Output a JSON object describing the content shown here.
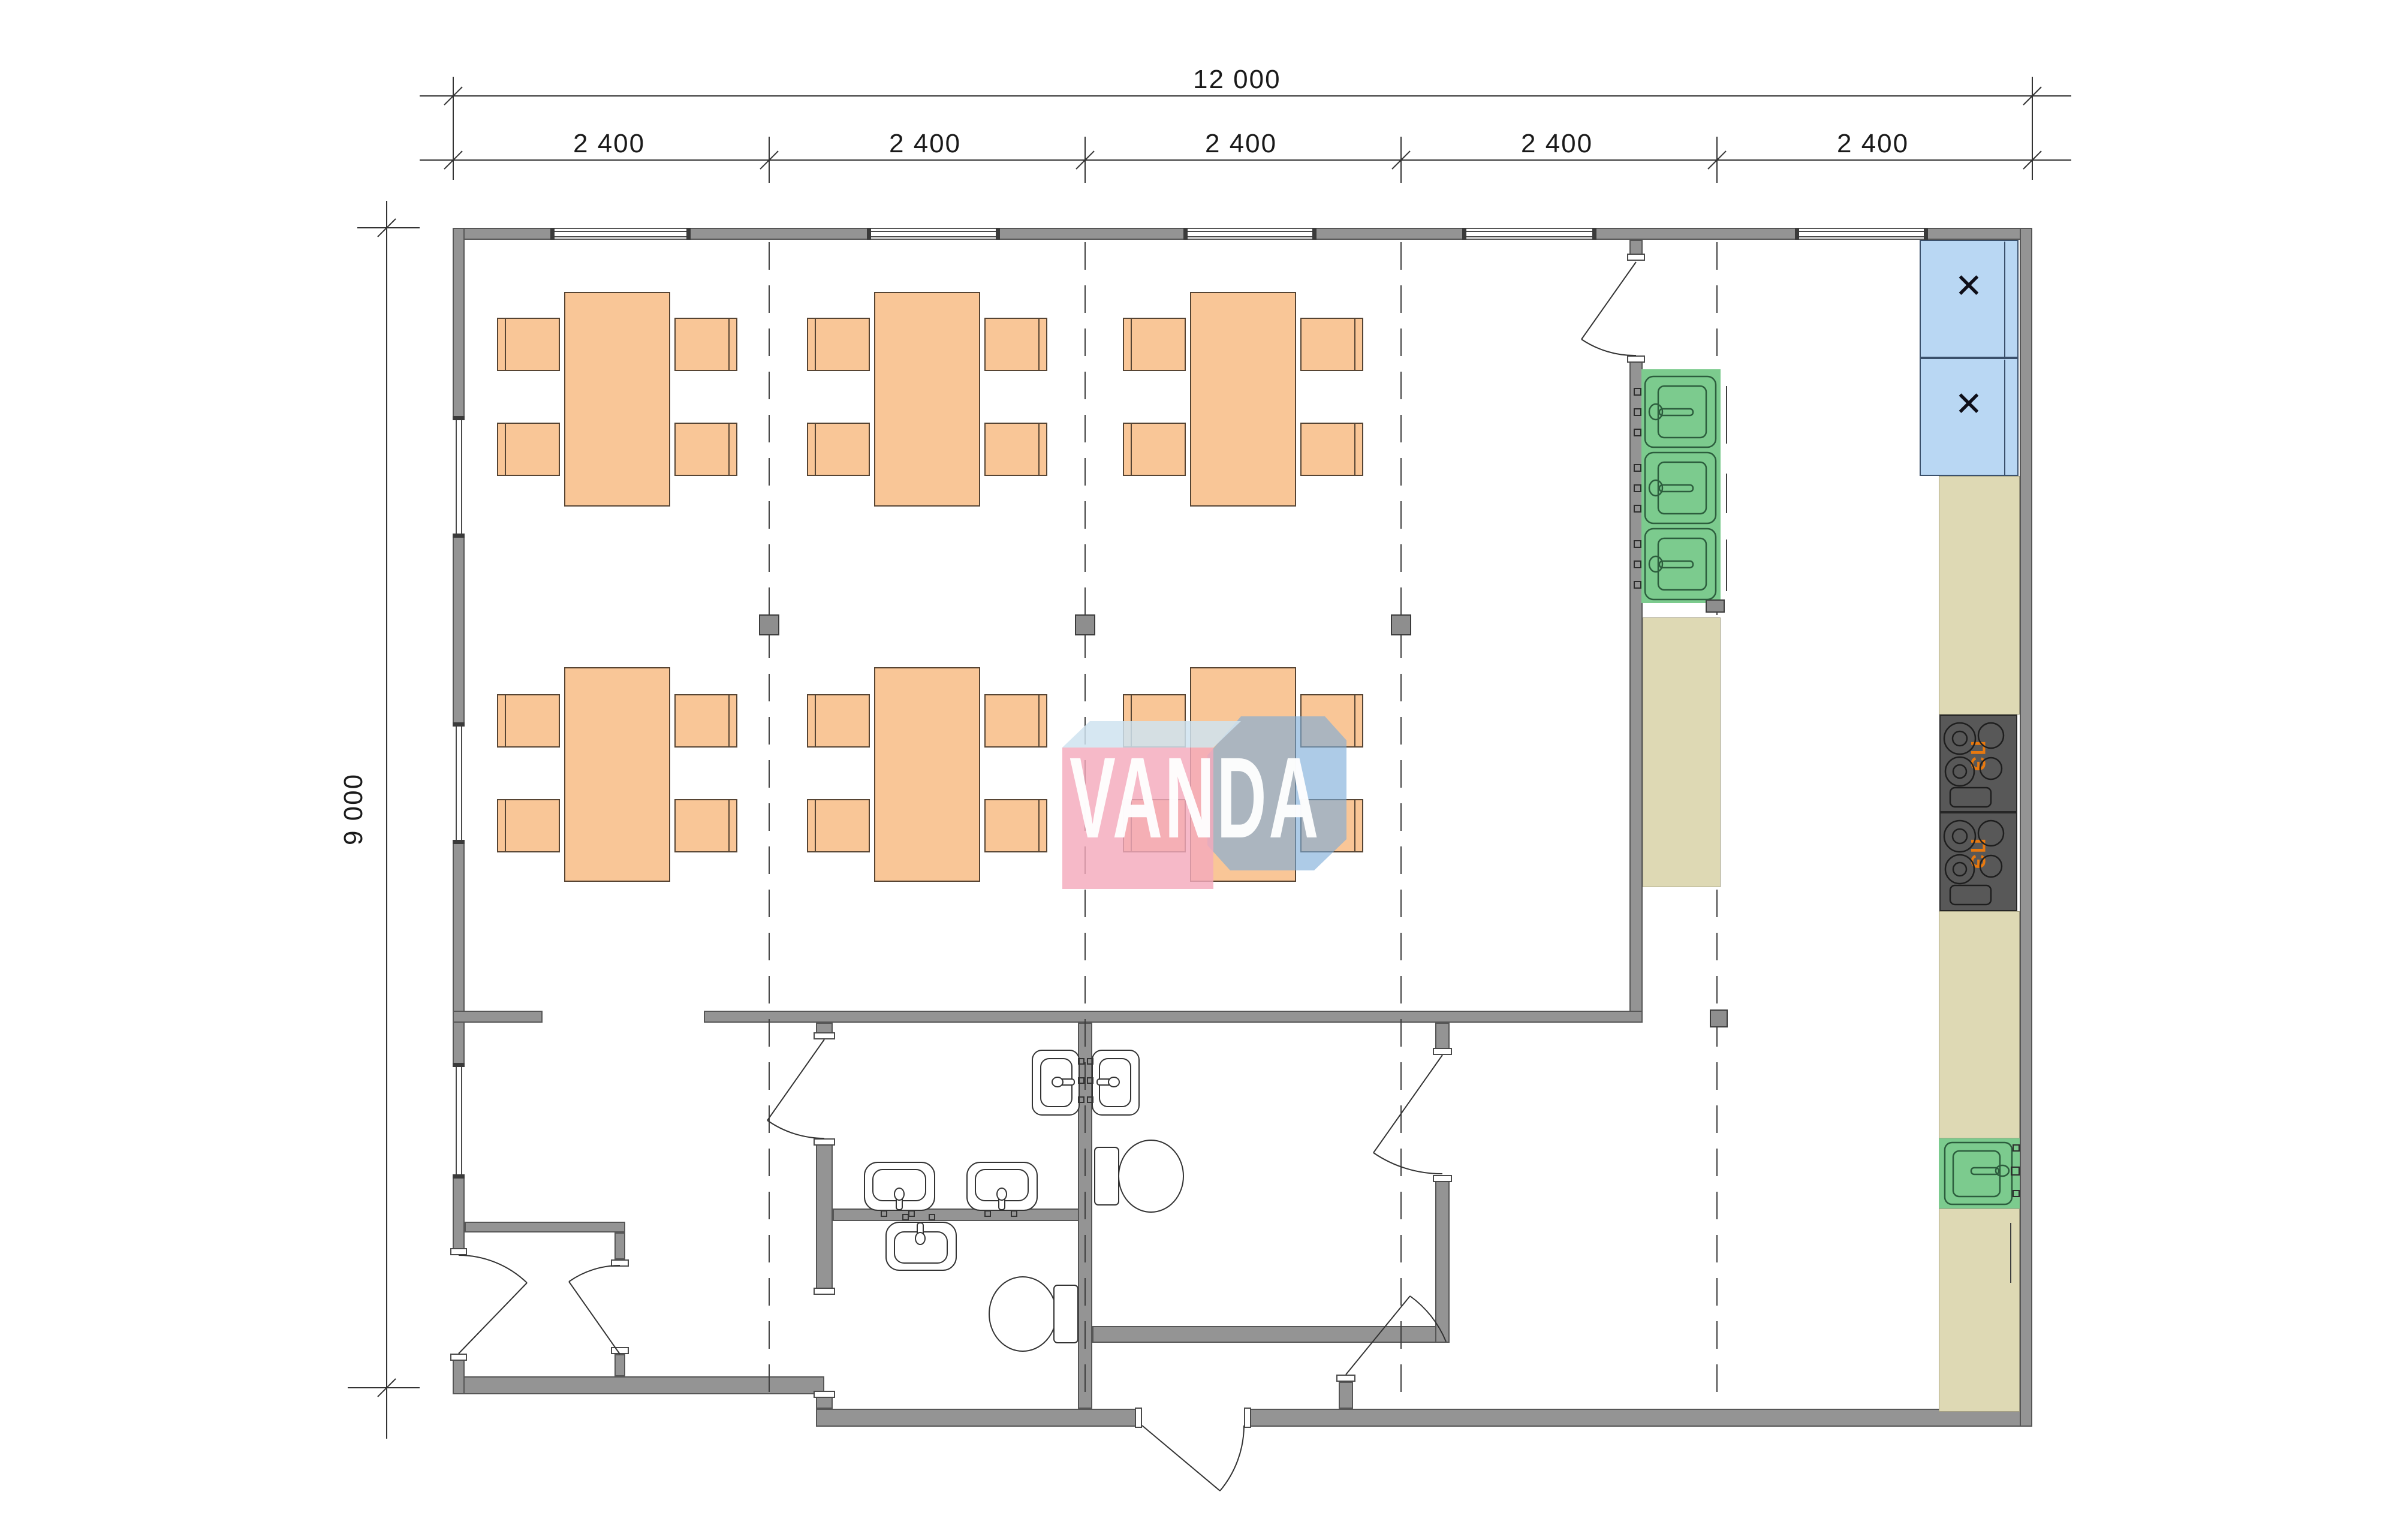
{
  "watermark": {
    "text": "VANDA"
  },
  "dimensions": {
    "overall_width_label": "12 000",
    "overall_height_label": "9 000",
    "top_segments": [
      "2 400",
      "2 400",
      "2 400",
      "2 400",
      "2 400"
    ]
  },
  "appliances": {
    "fridge_marks": [
      "✕",
      "✕"
    ],
    "stove_labels": [
      "ПЭ",
      "ПЭ"
    ]
  },
  "colors": {
    "wall": "#949494",
    "wall-edge": "#565656",
    "furniture": "#f9c697",
    "furniture-edge": "#564433",
    "counter": "#ded9b4",
    "counter-edge": "#a5a184",
    "green": "#7ccb8e",
    "green-edge": "#2c5d3d",
    "fridge": "#b9d7f3",
    "fridge-edge": "#3a506b",
    "stove": "#585858",
    "stove-edge": "#262626",
    "stove-label": "#e8790f",
    "line": "#333333",
    "mark": "#0e0e18"
  }
}
